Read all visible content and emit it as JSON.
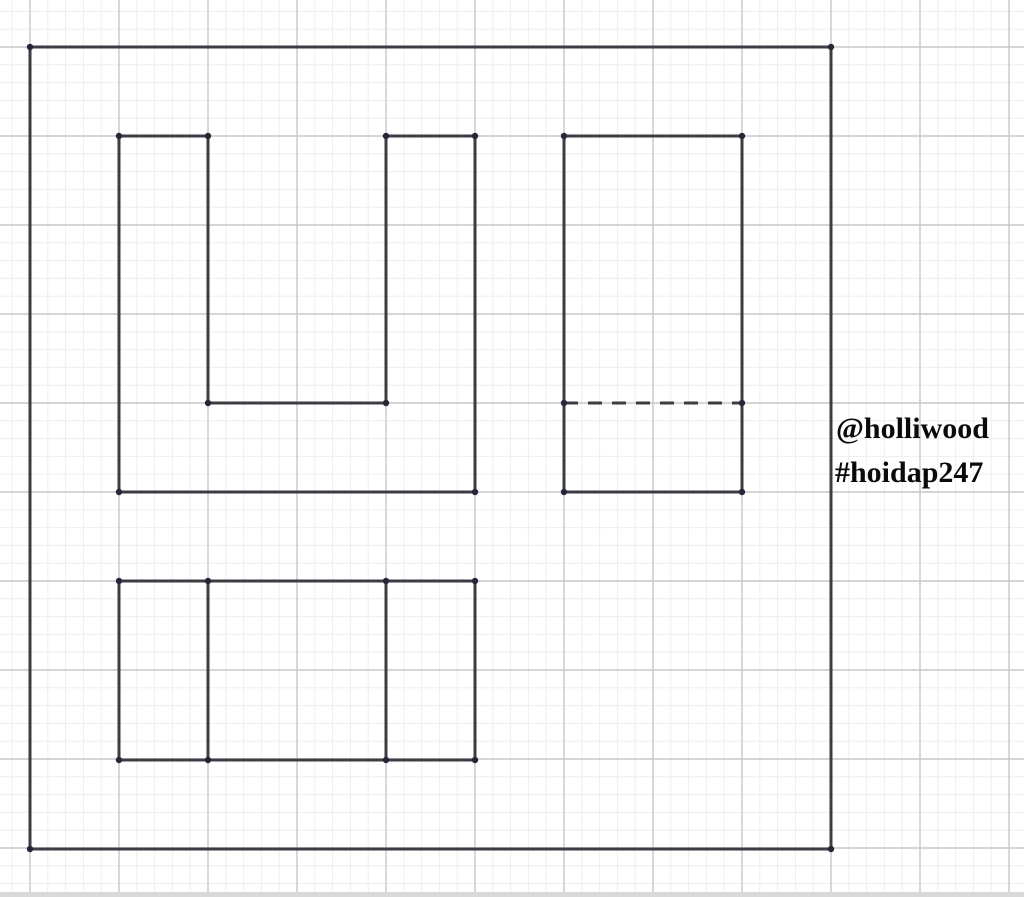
{
  "canvas": {
    "width": 1024,
    "height": 897,
    "background": "#ffffff"
  },
  "grid": {
    "origin_x": 30,
    "origin_y": 47,
    "major_spacing": 89,
    "minor_per_major": 5,
    "minor_color": "#eeeeef",
    "major_color": "#c7c7ca"
  },
  "style": {
    "stroke_color": "#3c3c42",
    "stroke_width": 3,
    "dot_color": "#26263a",
    "dot_radius": 3.2,
    "dash_pattern": "14 10"
  },
  "shapes": {
    "outer_frame": {
      "type": "rect",
      "x": 30,
      "y": 47,
      "width": 801,
      "height": 802
    },
    "front_view_u": {
      "type": "polygon",
      "points": [
        [
          119,
          136
        ],
        [
          208,
          136
        ],
        [
          208,
          403
        ],
        [
          386,
          403
        ],
        [
          386,
          136
        ],
        [
          475,
          136
        ],
        [
          475,
          492
        ],
        [
          119,
          492
        ]
      ]
    },
    "side_view": {
      "type": "rect",
      "x": 564,
      "y": 136,
      "width": 178,
      "height": 356
    },
    "side_view_hidden_edge": {
      "type": "dashed-line",
      "x1": 564,
      "y1": 403,
      "x2": 742,
      "y2": 403
    },
    "top_view": {
      "type": "rect",
      "x": 119,
      "y": 581,
      "width": 356,
      "height": 179
    },
    "top_view_divider_left": {
      "type": "line",
      "x1": 208,
      "y1": 581,
      "x2": 208,
      "y2": 760
    },
    "top_view_divider_right": {
      "type": "line",
      "x1": 386,
      "y1": 581,
      "x2": 386,
      "y2": 760
    }
  },
  "vertices": [
    [
      30,
      47
    ],
    [
      831,
      47
    ],
    [
      30,
      849
    ],
    [
      831,
      849
    ],
    [
      119,
      136
    ],
    [
      208,
      136
    ],
    [
      208,
      403
    ],
    [
      386,
      403
    ],
    [
      386,
      136
    ],
    [
      475,
      136
    ],
    [
      475,
      492
    ],
    [
      119,
      492
    ],
    [
      564,
      136
    ],
    [
      742,
      136
    ],
    [
      564,
      403
    ],
    [
      742,
      403
    ],
    [
      564,
      492
    ],
    [
      742,
      492
    ],
    [
      119,
      581
    ],
    [
      208,
      581
    ],
    [
      386,
      581
    ],
    [
      475,
      581
    ],
    [
      119,
      760
    ],
    [
      208,
      760
    ],
    [
      386,
      760
    ],
    [
      475,
      760
    ]
  ],
  "watermark": {
    "line1": "@holliwood",
    "line2": "#hoidap247",
    "color": "#0a0a0a"
  }
}
